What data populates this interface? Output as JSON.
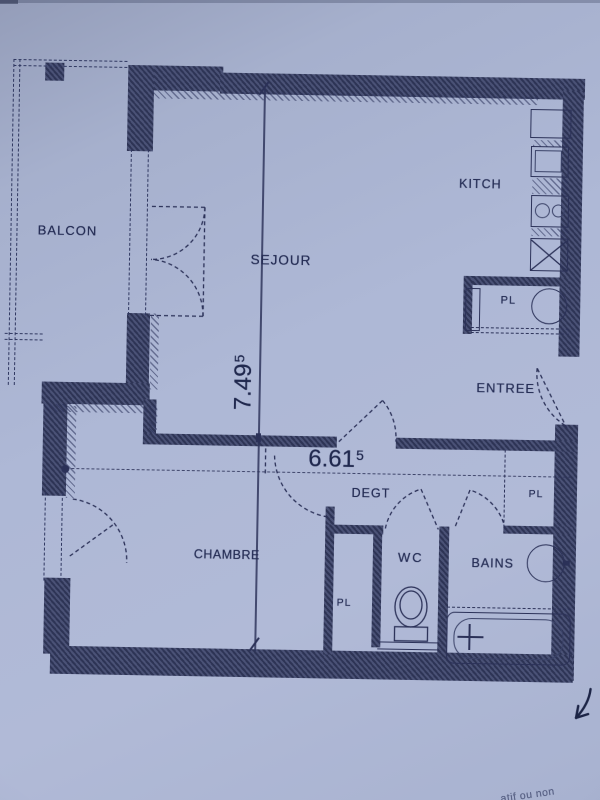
{
  "rooms": [
    {
      "label": "BALCON"
    },
    {
      "label": "SEJOUR"
    },
    {
      "label": "KITCH"
    },
    {
      "label": "ENTREE"
    },
    {
      "label": "DEGT"
    },
    {
      "label": "CHAMBRE"
    },
    {
      "label": "WC"
    },
    {
      "label": "BAINS"
    }
  ],
  "closets": [
    {
      "label": "PL"
    },
    {
      "label": "PL"
    },
    {
      "label": "PL"
    }
  ],
  "dimensions": {
    "vertical": {
      "value": "7.49",
      "superscript": "5"
    },
    "horizontal": {
      "value": "6.61",
      "superscript": "5"
    }
  },
  "footnote": {
    "text": "atif ou non"
  },
  "colors": {
    "paper": "#aab4d3",
    "ink": "#2b3158",
    "wall": "#3e4569"
  }
}
